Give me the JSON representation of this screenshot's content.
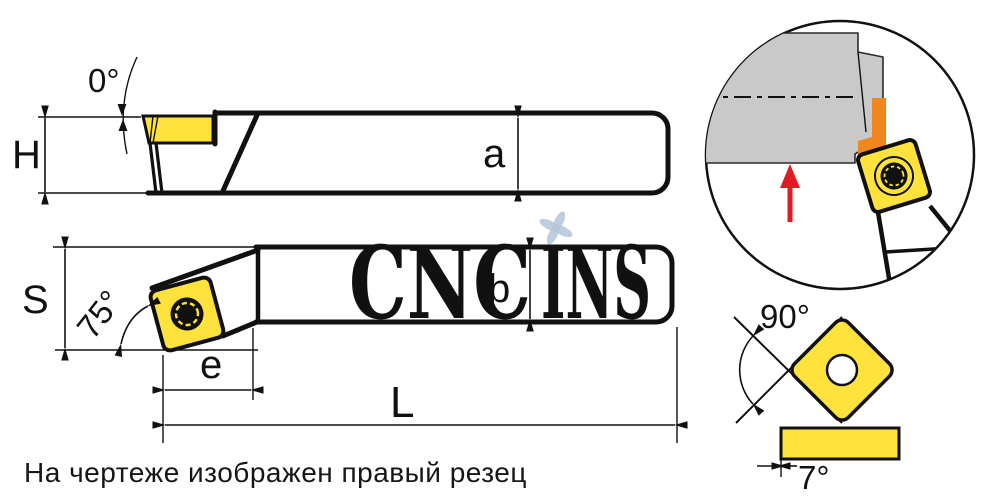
{
  "note": "На чертеже изображен правый резец",
  "watermark": {
    "cnc": "CNC",
    "ins": "INS"
  },
  "views": {
    "side": {
      "rake_angle_label": "0°",
      "height_label": "H",
      "dim_a_label": "a"
    },
    "plan": {
      "shank_label": "S",
      "lead_angle_label": "75°",
      "dim_b_label": "b",
      "overhang_label": "e",
      "length_label": "L"
    },
    "insert_detail": {
      "point_angle_label": "90°",
      "clearance_angle_label": "7°"
    }
  },
  "colors": {
    "insert_yellow": "#FFE33C",
    "workpiece_gray": "#C9C9C9",
    "chip_orange": "#F0861C",
    "feed_arrow_red": "#E11B22",
    "watermark_red": "rgba(231,118,96,0.5)",
    "watermark_blue": "rgba(172,192,212,0.6)",
    "line_black": "#111111"
  }
}
